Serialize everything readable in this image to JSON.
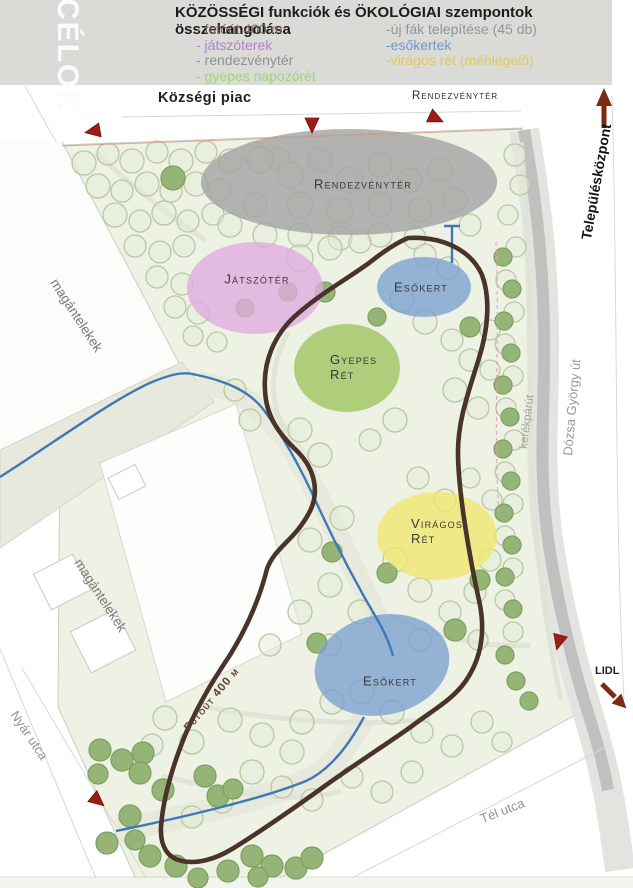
{
  "header": {
    "side_label": "CÉLOK",
    "title": "KÖZÖSSÉGI funkciók  és  ÖKOLÓGIAI szempontok összehangolása",
    "left_items": [
      {
        "label": "- futóút 400 m",
        "color": "#7e6a59"
      },
      {
        "label": "- játszóterek",
        "color": "#b77fc9"
      },
      {
        "label": "- rendezvénytér",
        "color": "#909090"
      },
      {
        "label": "- gyepes napozórét",
        "color": "#a3d279"
      }
    ],
    "right_items": [
      {
        "label": "-új fák telepítése (45 db)",
        "color": "#8d979e"
      },
      {
        "label": "-esőkertek",
        "color": "#6d99cf"
      },
      {
        "label": "-virágos rét (méhlegelő)",
        "color": "#e0cb59"
      }
    ]
  },
  "map": {
    "labels": {
      "market": "Községi piac",
      "event_entrance": "Rendezvénytér",
      "town_center": "Településközpont",
      "main_road": "Dózsa György út",
      "bike_path": "kerékpárút",
      "supermarket": "LIDL",
      "street_south": "Tél utca",
      "street_west": "Nyár utca",
      "plots_upper": "magántelekek",
      "plots_lower": "magántelekek",
      "track": "Futóút 400 m"
    },
    "zones": {
      "event": {
        "label": "Rendezvénytér",
        "color": "#a5a5a3"
      },
      "playground": {
        "label": "Játszótér",
        "color": "#e0abdf"
      },
      "rain_top": {
        "label": "Esőkert",
        "color": "#7ba0cf"
      },
      "lawn": {
        "line1": "Gyepes",
        "line2": "Rét",
        "color": "#9cc45e"
      },
      "flower": {
        "line1": "Virágos",
        "line2": "Rét",
        "color": "#f0e76e"
      },
      "rain_bottom": {
        "label": "Esőkert",
        "color": "#7ba0cf"
      }
    },
    "colors": {
      "park": "#edf2e5",
      "track": "#4a332a",
      "water": "#3c79b6",
      "road": "#c0c0be",
      "marker": "#9e1c15",
      "arrow": "#7c2a12",
      "tree_dark": "#95b577",
      "tree_dark_ring": "#7d9f5f",
      "tree_light_ring": "#b9c7a3"
    }
  }
}
